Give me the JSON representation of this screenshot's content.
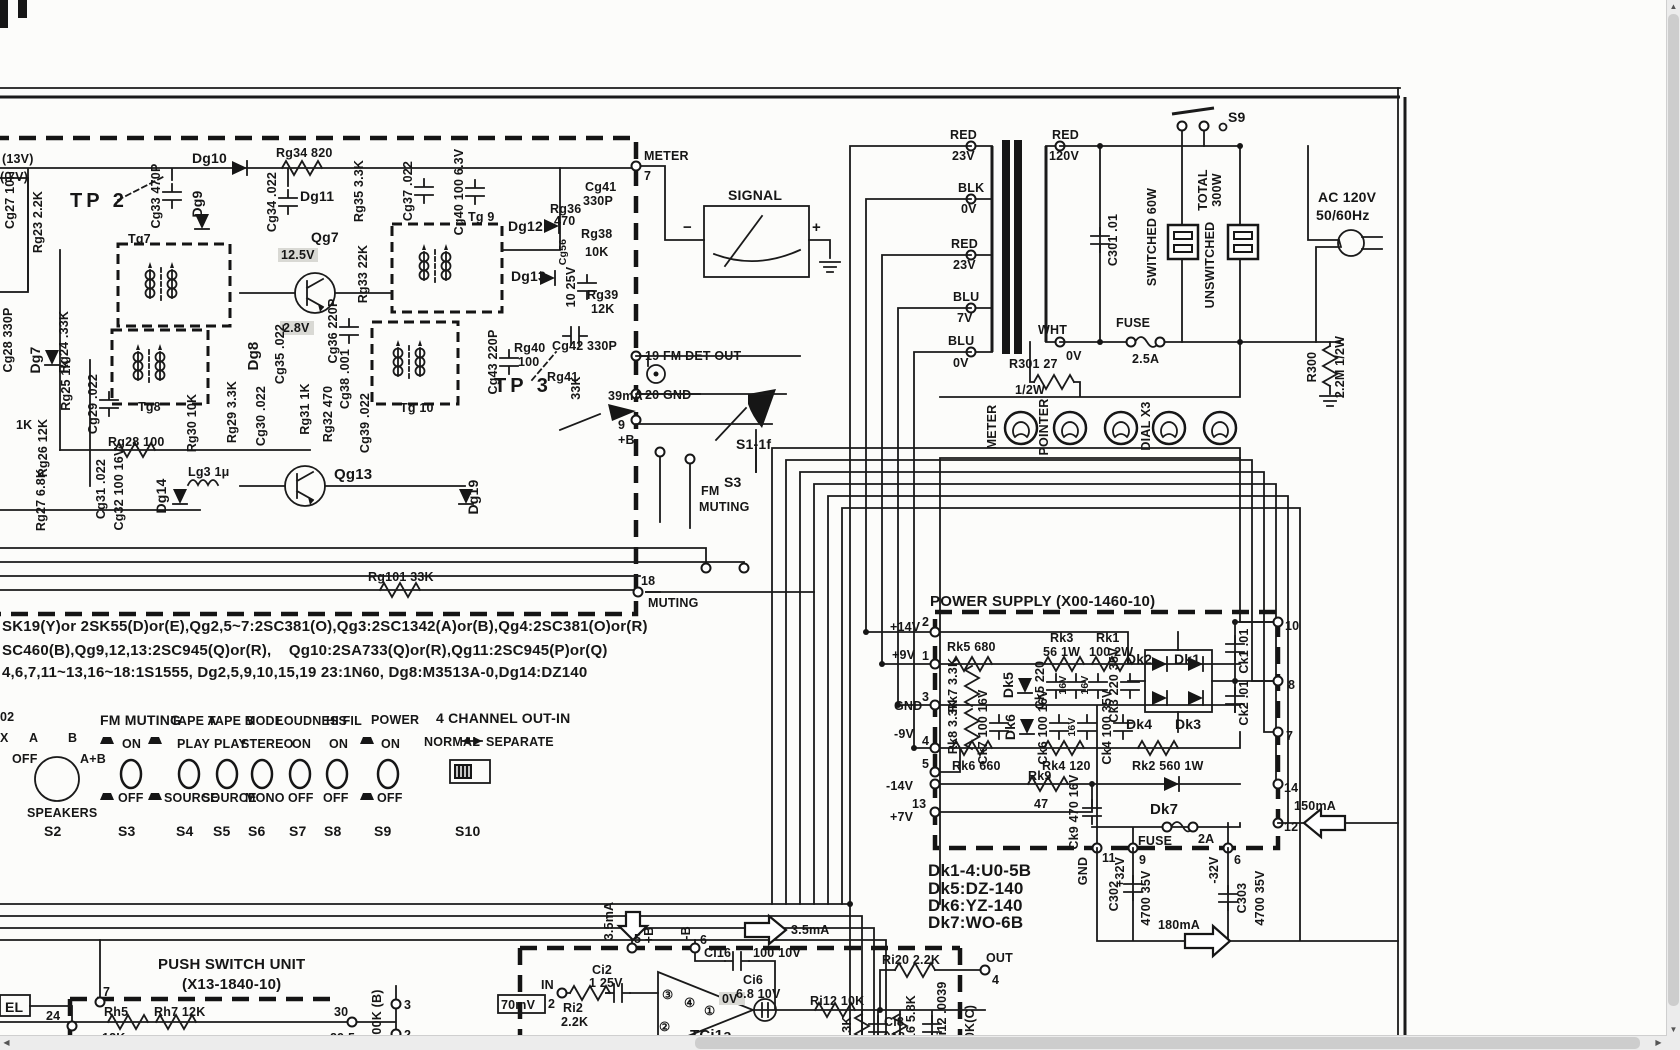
{
  "viewer": {
    "up": "▲",
    "down": "▼",
    "left": "◀",
    "right": "▶"
  },
  "if_unit": {
    "v13": "(13V)",
    "v07": "(.7V)",
    "tp2": "TP 2",
    "tp3": "TP 3",
    "cg27": "Cg27 10P",
    "rg23": "Rg23 2.2K",
    "cg28": "Cg28 330P",
    "dg7": "Dg7",
    "rg24": "Rg24 .33K",
    "rg25": "Rg25 1K",
    "k1": "1K",
    "rg26": "Rg26 12K",
    "rg27": "Rg27 6.8K",
    "cg31": "Cg31 .022",
    "cg32": "Cg32 100 16V",
    "dg14": "Dg14",
    "lg3": "Lg3 1μ",
    "rg28": "Rg28 100",
    "cg33": "Cg33 470P",
    "dg9": "Dg9",
    "dg10": "Dg10",
    "rg34": "Rg34 820",
    "cg34": "Cg34 .022",
    "dg11": "Dg11",
    "rg35": "Rg35 3.3K",
    "cg37": "Cg37 .022",
    "cg40": "Cg40 100 6.3V",
    "tg9": "Tg 9",
    "dg12": "Dg12",
    "dg13": "Dg13",
    "cg56": "Cg56",
    "rg36a": "Rg36",
    "rg36b": "470",
    "rg38a": "Rg38",
    "rg38b": "10K",
    "cg41a": "Cg41",
    "cg41b": "330P",
    "c1025": "10 25V",
    "rg39a": "Rg39",
    "rg39b": "12K",
    "cg42": "Cg42 330P",
    "tg7": "Tg7",
    "qg7": "Qg7",
    "v125": "12.5V",
    "v28": "2.8V",
    "rg33": "Rg33 22K",
    "cg36": "Cg36 220P",
    "tg8": "Tg8",
    "rg30": "Rg30 10K",
    "rg29": "Rg29 3.3K",
    "cg30": "Cg30 .022",
    "cg29": "Cg29 .022",
    "dg8": "Dg8",
    "cg35": "Cg35 .022",
    "rg31": "Rg31 1K",
    "rg32": "Rg32 470",
    "cg38": "Cg38 .001",
    "cg39": "Cg39 .022",
    "tg10": "Tg 10",
    "cg43": "Cg43 220P",
    "rg40a": "Rg40",
    "rg40b": "100",
    "rg41": "Rg41",
    "r33k": "33K",
    "qg13": "Qg13",
    "dg19": "Dg19",
    "rg101": "Rg101 33K",
    "i39": "39mA",
    "p9": "9",
    "pb": "+B",
    "p7": "7",
    "meter": "METER",
    "p19": "19 FM DET OUT",
    "p20": "20 GND",
    "p18": "18",
    "muting": "MUTING"
  },
  "meter": {
    "signal": "SIGNAL",
    "minus": "−",
    "plus": "+"
  },
  "xfmr": {
    "red1": "RED",
    "v23a": "23V",
    "blk": "BLK",
    "v0a": "0V",
    "red2": "RED",
    "v23b": "23V",
    "blu1": "BLU",
    "v7": "7V",
    "blu2": "BLU",
    "v0b": "0V",
    "red3": "RED",
    "v120": "120V",
    "wht": "WHT",
    "v0c": "0V"
  },
  "ac": {
    "c301": "C301 .01",
    "fuse": "FUSE",
    "amps": "2.5A",
    "s9": "S9",
    "sw60": "SWITCHED 60W",
    "total": "TOTAL",
    "w300": "300W",
    "unsw": "UNSWITCHED",
    "acv": "AC 120V",
    "hz": "50/60Hz",
    "r300": "R300",
    "r300v": "2.2M 1/2W"
  },
  "lamps": {
    "r301": "R301 27",
    "r301b": "1/2W",
    "meter": "METER",
    "pointer": "POINTER",
    "dial": "DIAL X3"
  },
  "s1": {
    "label": "S1-1f"
  },
  "s3sw": {
    "fm": "FM",
    "s3": "S3",
    "muting": "MUTING"
  },
  "parts": {
    "l1": "SK19(Y)or 2SK55(D)or(E),Qg2,5~7:2SC381(O),Qg3:2SC1342(A)or(B),Qg4:2SC381(O)or(R)",
    "l2": "SC460(B),Qg9,12,13:2SC945(Q)or(R),    Qg10:2SA733(Q)or(R),Qg11:2SC945(P)or(Q)",
    "l3": "4,6,7,11~13,16~18:1S1555, Dg2,5,9,10,15,19 23:1N60, Dg8:M3513A-0,Dg14:DZ140"
  },
  "switches": {
    "x02": "02",
    "x": "X",
    "a": "A",
    "b": "B",
    "off": "OFF",
    "ab": "A+B",
    "speakers": "SPEAKERS",
    "s2": "S2",
    "fm_title": "FM MUTING",
    "fm_on": "ON",
    "fm_off": "OFF",
    "s3": "S3",
    "ta_title": "TAPE A",
    "ta_on": "PLAY",
    "ta_off": "SOURCE",
    "s4": "S4",
    "tb_title": "TAPE B",
    "tb_on": "PLAY",
    "tb_off": "SOURCE",
    "s5": "S5",
    "mo_title": "MODE",
    "mo_on": "STEREO",
    "mo_off": "MONO",
    "s6": "S6",
    "lo_title": "LOUDNESS",
    "lo_on": "ON",
    "lo_off": "OFF",
    "s7": "S7",
    "hf_title": "HI FIL",
    "hf_on": "ON",
    "hf_off": "OFF",
    "s8": "S8",
    "pw_title": "POWER",
    "pw_on": "ON",
    "pw_off": "OFF",
    "s9": "S9",
    "ch_title": "4 CHANNEL OUT-IN",
    "normal": "NORMAL",
    "separate": "SEPARATE",
    "s10": "S10"
  },
  "psu": {
    "title": "POWER SUPPLY (X00-1460-10)",
    "p14v": "+14V",
    "n2": "2",
    "p9v": "+9V",
    "n1": "1",
    "gnd": "GND",
    "n3": "3",
    "n9v": "-9V",
    "n4": "4",
    "n5": "5",
    "n14v": "-14V",
    "n13": "13",
    "p7v": "+7V",
    "rk5": "Rk5 680",
    "rk7": "Rk7 3.3K",
    "dk5": "Dk5",
    "ck5": "Ck5 220",
    "v16a": "16V",
    "v16b": "16V",
    "rk3a": "Rk3",
    "rk3b": "56 1W",
    "rk1a": "Rk1",
    "rk1b": "100 2W",
    "ck3": "Ck3 220 35V",
    "dk2": "Dk2",
    "dk1": "Dk1",
    "dk4": "Dk4",
    "dk3": "Dk3",
    "ck1": "Ck1 .01",
    "ck2": "Ck2 .01",
    "rk8": "Rk8 3.3K",
    "ck7": "Ck7 100 16V",
    "dk6": "Dk6",
    "ck6": "Ck6 100 16V",
    "v16c": "16V",
    "ck4": "Ck4 100 35V",
    "rk6": "Rk6 660",
    "rk4": "Rk4 120",
    "rk2": "Rk2 560 1W",
    "rk9a": "Rk9",
    "rk9b": "47",
    "ck9": "Ck9 470 16V",
    "dk7": "Dk7",
    "fuse": "FUSE",
    "amps": "2A",
    "n10": "10",
    "n8": "8",
    "n7": "7",
    "n14": "14",
    "n12": "12",
    "gndb": "GND",
    "n11": "11",
    "p32": "+32V",
    "n9": "9",
    "m32": "-32V",
    "n6": "6",
    "i150": "150mA",
    "i180": "180mA",
    "c302": "C302",
    "c302v": "4700 35V",
    "c303": "C303",
    "c303v": "4700 35V",
    "note1": "Dk1-4:U0-5B",
    "note2": "Dk5:DZ-140",
    "note3": "Dk6:YZ-140",
    "note4": "Dk7:WO-6B"
  },
  "push": {
    "title": "PUSH SWITCH UNIT",
    "sub": "(X13-1840-10)",
    "el": "EL",
    "n24": "24",
    "n7": "7",
    "rh5": "Rh5",
    "rh5b": "12K",
    "rh7": "Rh7 12K",
    "n30": "30",
    "n295": "29.5",
    "pot": "00K (B)",
    "n3": "3",
    "n2": "2"
  },
  "tone": {
    "i35a": "3.5mA",
    "n5": "5",
    "pb": "+B",
    "mb": "-B",
    "n6": "6",
    "i35b": "3.5mA",
    "ci16": "Ci16",
    "ci16v": "100 10V",
    "ci2": "Ci2",
    "ci2v": "1 25V",
    "in": "IN",
    "n2": "2",
    "mv": "70mV",
    "ri2": "Ri2",
    "ri2v": "2.2K",
    "tci": "TCi1a",
    "pin3": "③",
    "pin4": "④",
    "pin1": "①",
    "pin2": "②",
    "v0": "0V",
    "ci6": "Ci6",
    "ci6v": "6.8 10V",
    "ri12": "Ri12 10K",
    "r33": "3.3K",
    "ci8": "Ci8",
    "ci8v": ".018",
    "ri16": "Ri16 5.8K",
    "ci12": "Ci12 .0039",
    "pot": "0K(C)",
    "ri20": "Ri20 2.2K",
    "out": "OUT",
    "n4": "4"
  }
}
